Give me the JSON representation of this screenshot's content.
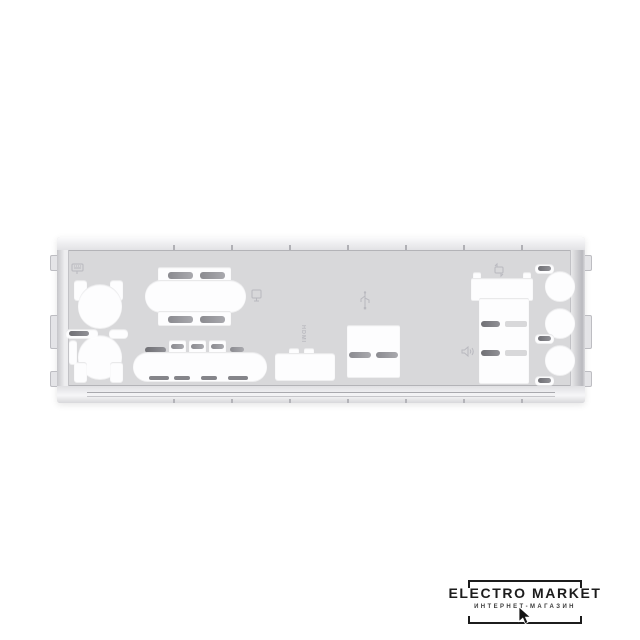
{
  "background_color": "#ffffff",
  "watermark": {
    "brand": "ELECTRO MARKET",
    "tagline": "ИНТЕРНЕТ-МАГАЗИН",
    "color": "#1c1c1c",
    "cursor_icon": "mouse-cursor-icon"
  },
  "shield": {
    "description": "motherboard rear I/O shield back plate, brushed light-gray metal on white background",
    "colors": {
      "bg": "#ffffff",
      "face": "#d8d8da",
      "fold": "#ededef",
      "fold_line": "#b3b3b7",
      "cutout": "#fdfdfe",
      "slot_dark": "#85858a",
      "slot_mid": "#a0a0a6",
      "emboss": "#b9b9bf",
      "logo": "#1c1c1c"
    },
    "labels": {
      "hdmi": "HDMI"
    },
    "icons": [
      "keyboard-mouse-icon",
      "display-icon",
      "usb-icon",
      "lan-icon",
      "audio-speaker-icon",
      "mouse-cursor-icon"
    ],
    "ports": [
      "ps2-keyboard",
      "ps2-mouse",
      "dvi",
      "vga",
      "hdmi",
      "usb-stack-center",
      "lan-usb-stack",
      "audio-jack-1",
      "audio-jack-2",
      "audio-jack-3"
    ]
  }
}
